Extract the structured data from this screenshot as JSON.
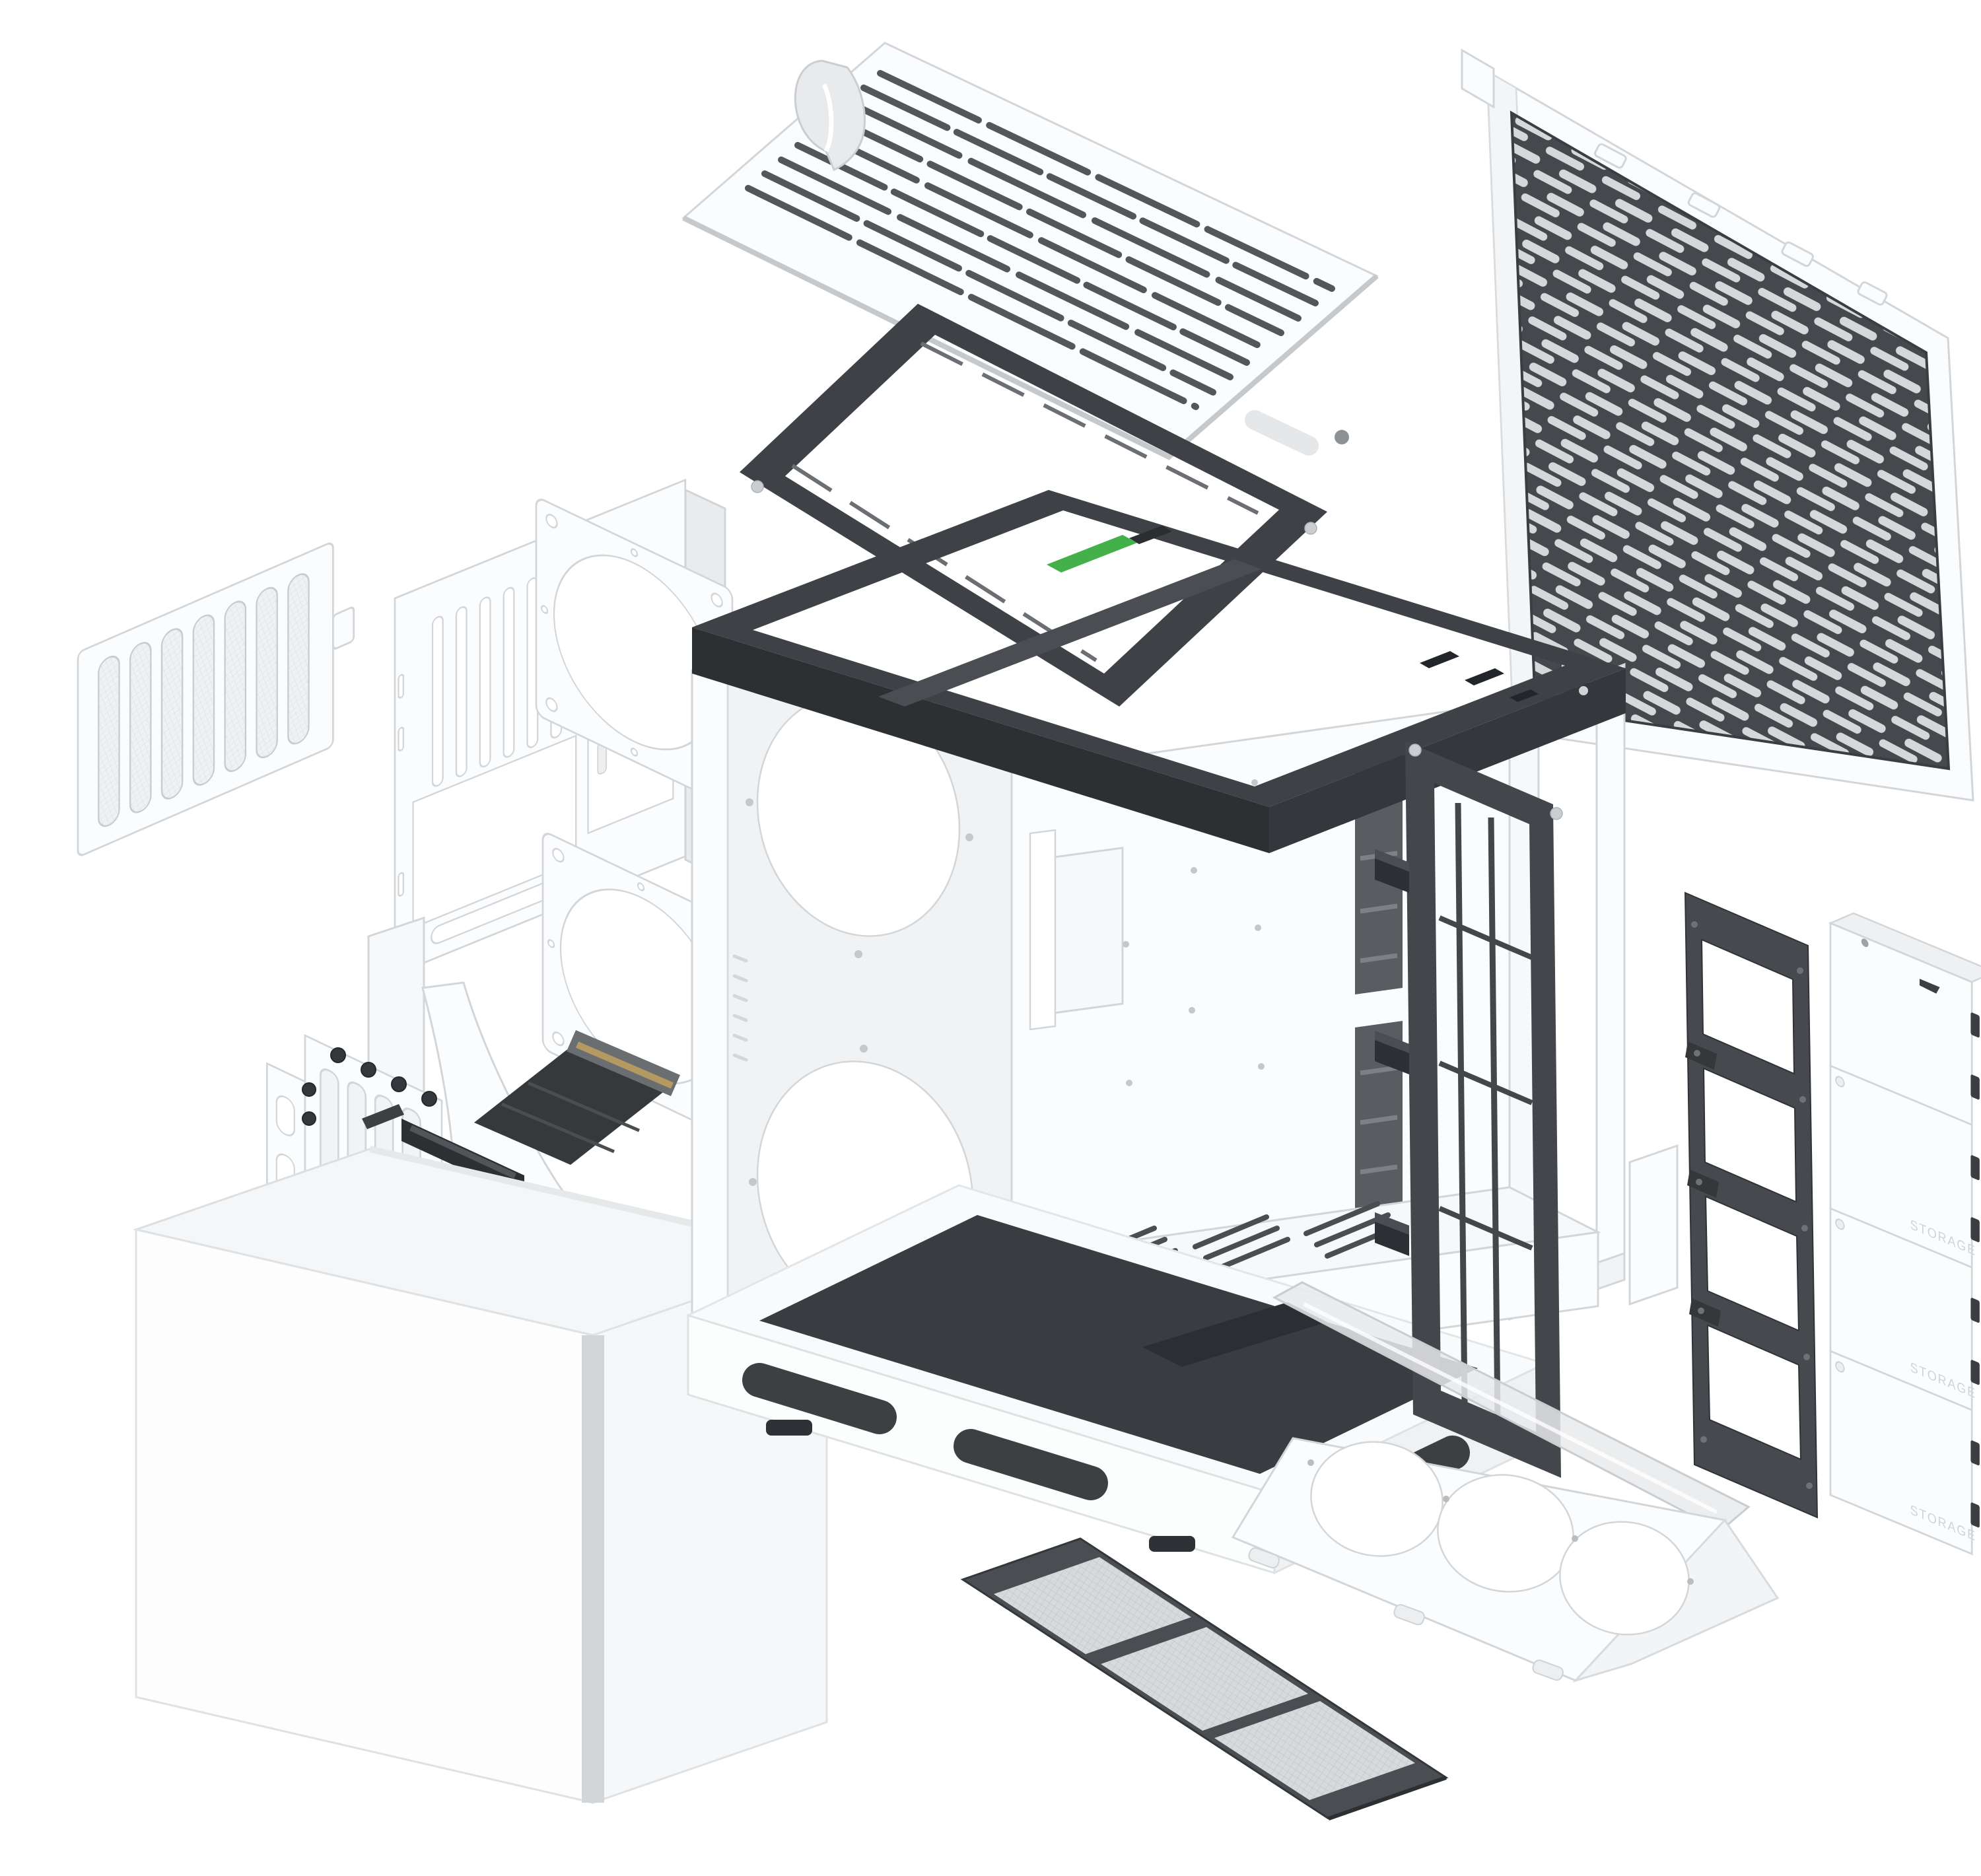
{
  "diagram": {
    "kind": "exploded-view",
    "subject": "Mid-tower PC case exploded into its panels, brackets and accessories",
    "background": "#ffffff",
    "labels": {
      "storage": "STORAGE"
    },
    "colors": {
      "background": "#ffffff",
      "part-white": "#fbfcfd",
      "part-white-shade": "#eef0f2",
      "outline": "#d3d6d9",
      "dark-metal": "#3e4246",
      "dark-metal-deep": "#2c3033",
      "mesh-light": "#d6d8da",
      "mesh-frame": "#45494d",
      "filter-mesh": "#d7d9da",
      "pcb-green": "#43b049",
      "riser-gold": "#b49a62",
      "base-deck": "#393d41",
      "trim-silver": "#d3d6d8"
    },
    "parts": [
      {
        "id": "top-panel",
        "description": "White vented top panel with fabric pull strap"
      },
      {
        "id": "top-radiator-bracket",
        "description": "Dark steel top radiator/fan bracket frame"
      },
      {
        "id": "front-mesh-panel",
        "description": "White front panel with dark perforated mesh"
      },
      {
        "id": "rear-panel",
        "description": "White rear panel with exhaust vents and cutouts"
      },
      {
        "id": "side-vent-filter",
        "description": "Small white side vent filter"
      },
      {
        "id": "fan-adapter-plate-1",
        "description": "White square fan adapter plate"
      },
      {
        "id": "fan-adapter-plate-2",
        "description": "White square fan adapter plate"
      },
      {
        "id": "chassis-frame",
        "description": "Main chassis with dark top frame, fan wall, PSU shroud and base"
      },
      {
        "id": "vertical-gpu-bracket",
        "description": "Vertical GPU mount with PCI slot covers and riser cable"
      },
      {
        "id": "outer-shell",
        "description": "Wrap-around white outer shell"
      },
      {
        "id": "side-fan-bracket",
        "description": "Dark side fan/radiator bracket with quick-release clips"
      },
      {
        "id": "ssd-bracket",
        "description": "Dark four-bay SSD bracket ladder"
      },
      {
        "id": "storage-tray-stack",
        "description": "Four stacked white storage drive trays"
      },
      {
        "id": "bottom-fan-tray",
        "description": "White triple-fan bottom bracket with clear guide"
      },
      {
        "id": "bottom-dust-filter",
        "description": "Dark three-section bottom dust filter"
      }
    ]
  }
}
